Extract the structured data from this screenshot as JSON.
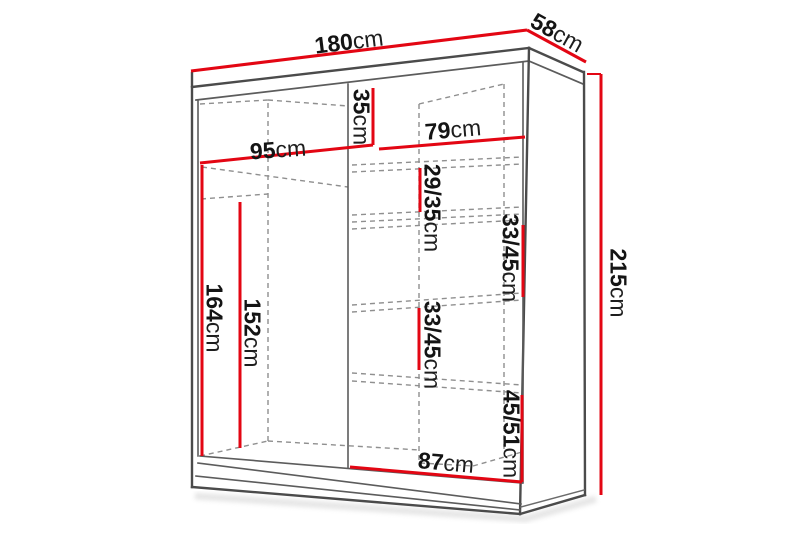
{
  "diagram": {
    "subject": "wardrobe-dimension-diagram",
    "unit": "cm",
    "colors": {
      "dimension_line": "#e30613",
      "structure_line": "#4b4b4b",
      "hidden_line": "#8f8f8f",
      "background": "#ffffff",
      "text": "#141414"
    },
    "labels": {
      "width": {
        "value": "180",
        "unit": "cm"
      },
      "depth": {
        "value": "58",
        "unit": "cm"
      },
      "height": {
        "value": "215",
        "unit": "cm"
      },
      "left_section_width": {
        "value": "95",
        "unit": "cm"
      },
      "top_compartment_height": {
        "value": "35",
        "unit": "cm"
      },
      "right_section_top_width": {
        "value": "79",
        "unit": "cm"
      },
      "left_section_clear_height": {
        "value": "164",
        "unit": "cm"
      },
      "hanging_space_height": {
        "value": "152",
        "unit": "cm"
      },
      "shelf_gap_1": {
        "value": "29/35",
        "unit": "cm"
      },
      "shelf_gap_2": {
        "value": "33/45",
        "unit": "cm"
      },
      "shelf_gap_3": {
        "value": "33/45",
        "unit": "cm"
      },
      "shelf_gap_4": {
        "value": "45/51",
        "unit": "cm"
      },
      "right_section_bottom_width": {
        "value": "87",
        "unit": "cm"
      }
    }
  }
}
